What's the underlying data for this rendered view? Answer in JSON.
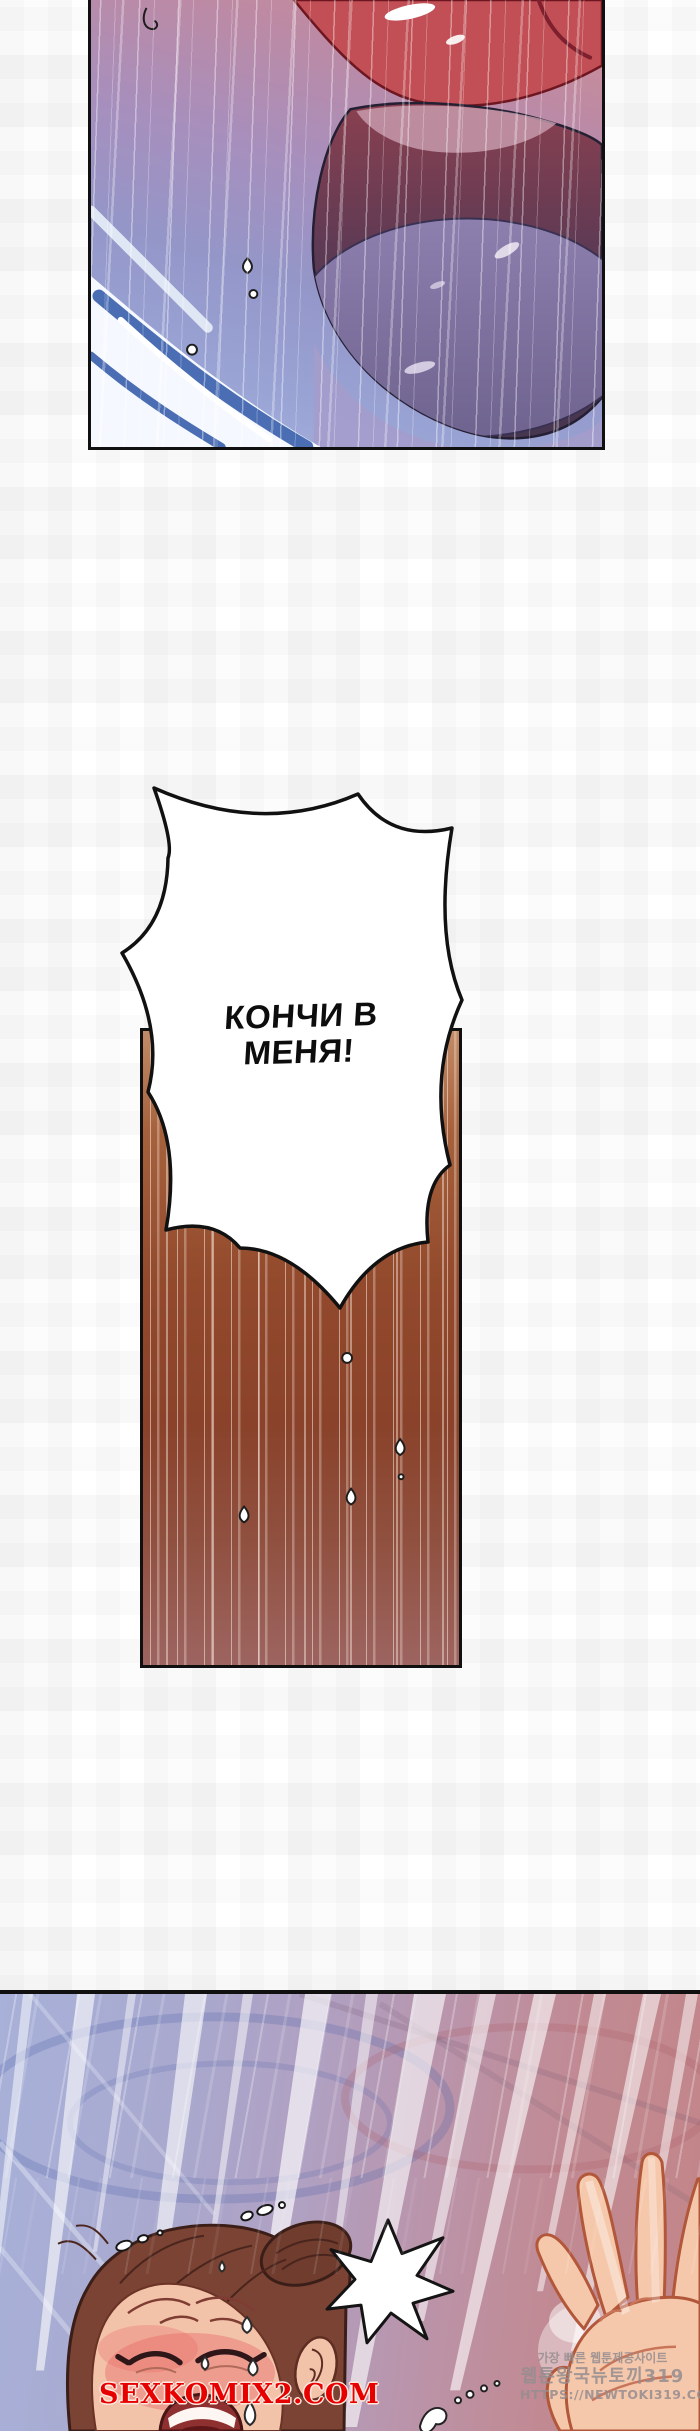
{
  "page": {
    "type": "adult-webtoon-comic-page",
    "width": 700,
    "height": 2431
  },
  "speech_bubble": {
    "line1": "КОНЧИ В",
    "line2": "МЕНЯ!"
  },
  "watermarks": {
    "site": "SEXKOMIX2.COM",
    "korean_line1": "가장 빠른 웹툰제공사이트",
    "korean_line2": "웹툰왕국뉴토끼319",
    "korean_line3": "HTTPS://NEWTOKI319.COM"
  },
  "colors": {
    "panel_border": "#101010",
    "site_watermark_red": "#e60000",
    "korean_watermark_gray": "#948c8f",
    "top_panel_red_glow": "#c23a3a",
    "top_panel_blue": "#99a4d5",
    "brown_panel_top": "#c28b67",
    "brown_panel_mid": "#8a422a",
    "brown_panel_bottom": "#9d6460",
    "bottom_panel_left": "#a8b1d9",
    "bottom_panel_right": "#c28588",
    "skin": "#f3c3a9",
    "hair": "#7a4334"
  }
}
